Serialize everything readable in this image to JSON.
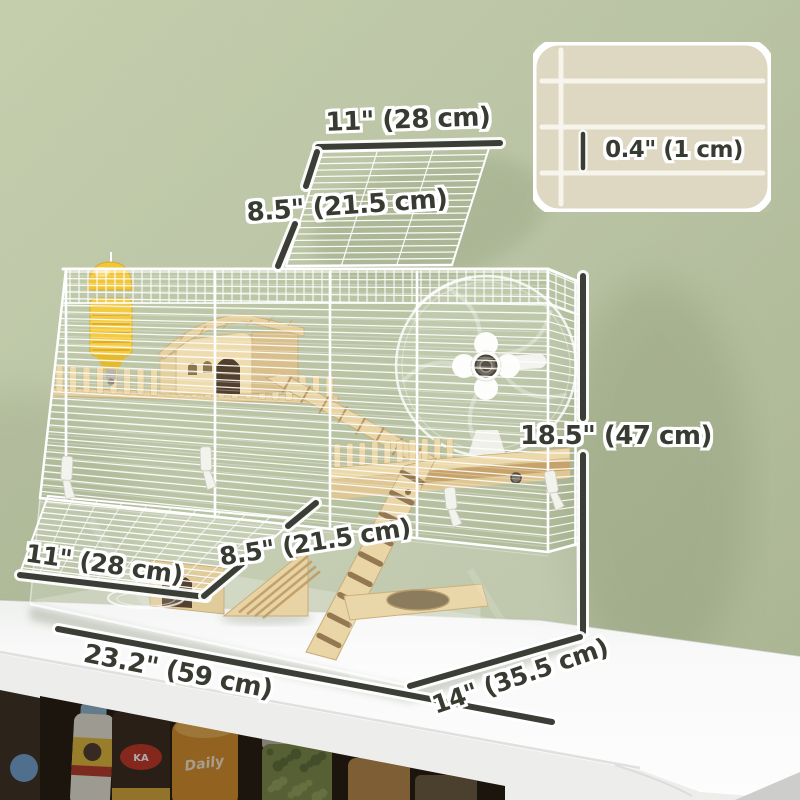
{
  "dimensions": {
    "lid_width": "11\" (28 cm)",
    "lid_depth": "8.5\" (21.5 cm)",
    "wire_spacing": "0.4\" (1 cm)",
    "cage_height": "18.5\" (47 cm)",
    "shelf_width": "11\" (28 cm)",
    "shelf_depth": "8.5\" (21.5 cm)",
    "cage_length": "23.2\" (59 cm)",
    "cage_depth": "14\" (35.5 cm)"
  },
  "shelf_packages": {
    "bag_logo": "KA",
    "bottle_label": "Daily"
  },
  "colors": {
    "wall": "#b7c2a1",
    "dimension_line": "#3b3e36",
    "label_text": "#383b32",
    "cage_wire": "#ffffff",
    "wood_light": "#ecd9ab",
    "wood_mid": "#e2cd9d",
    "wood_dark": "#c9ad78",
    "wood_rung": "#b2905c",
    "water_bottle_yellow": "#f2c838",
    "table_white": "#f6f7f6",
    "inset_background": "#ddd6c0"
  }
}
